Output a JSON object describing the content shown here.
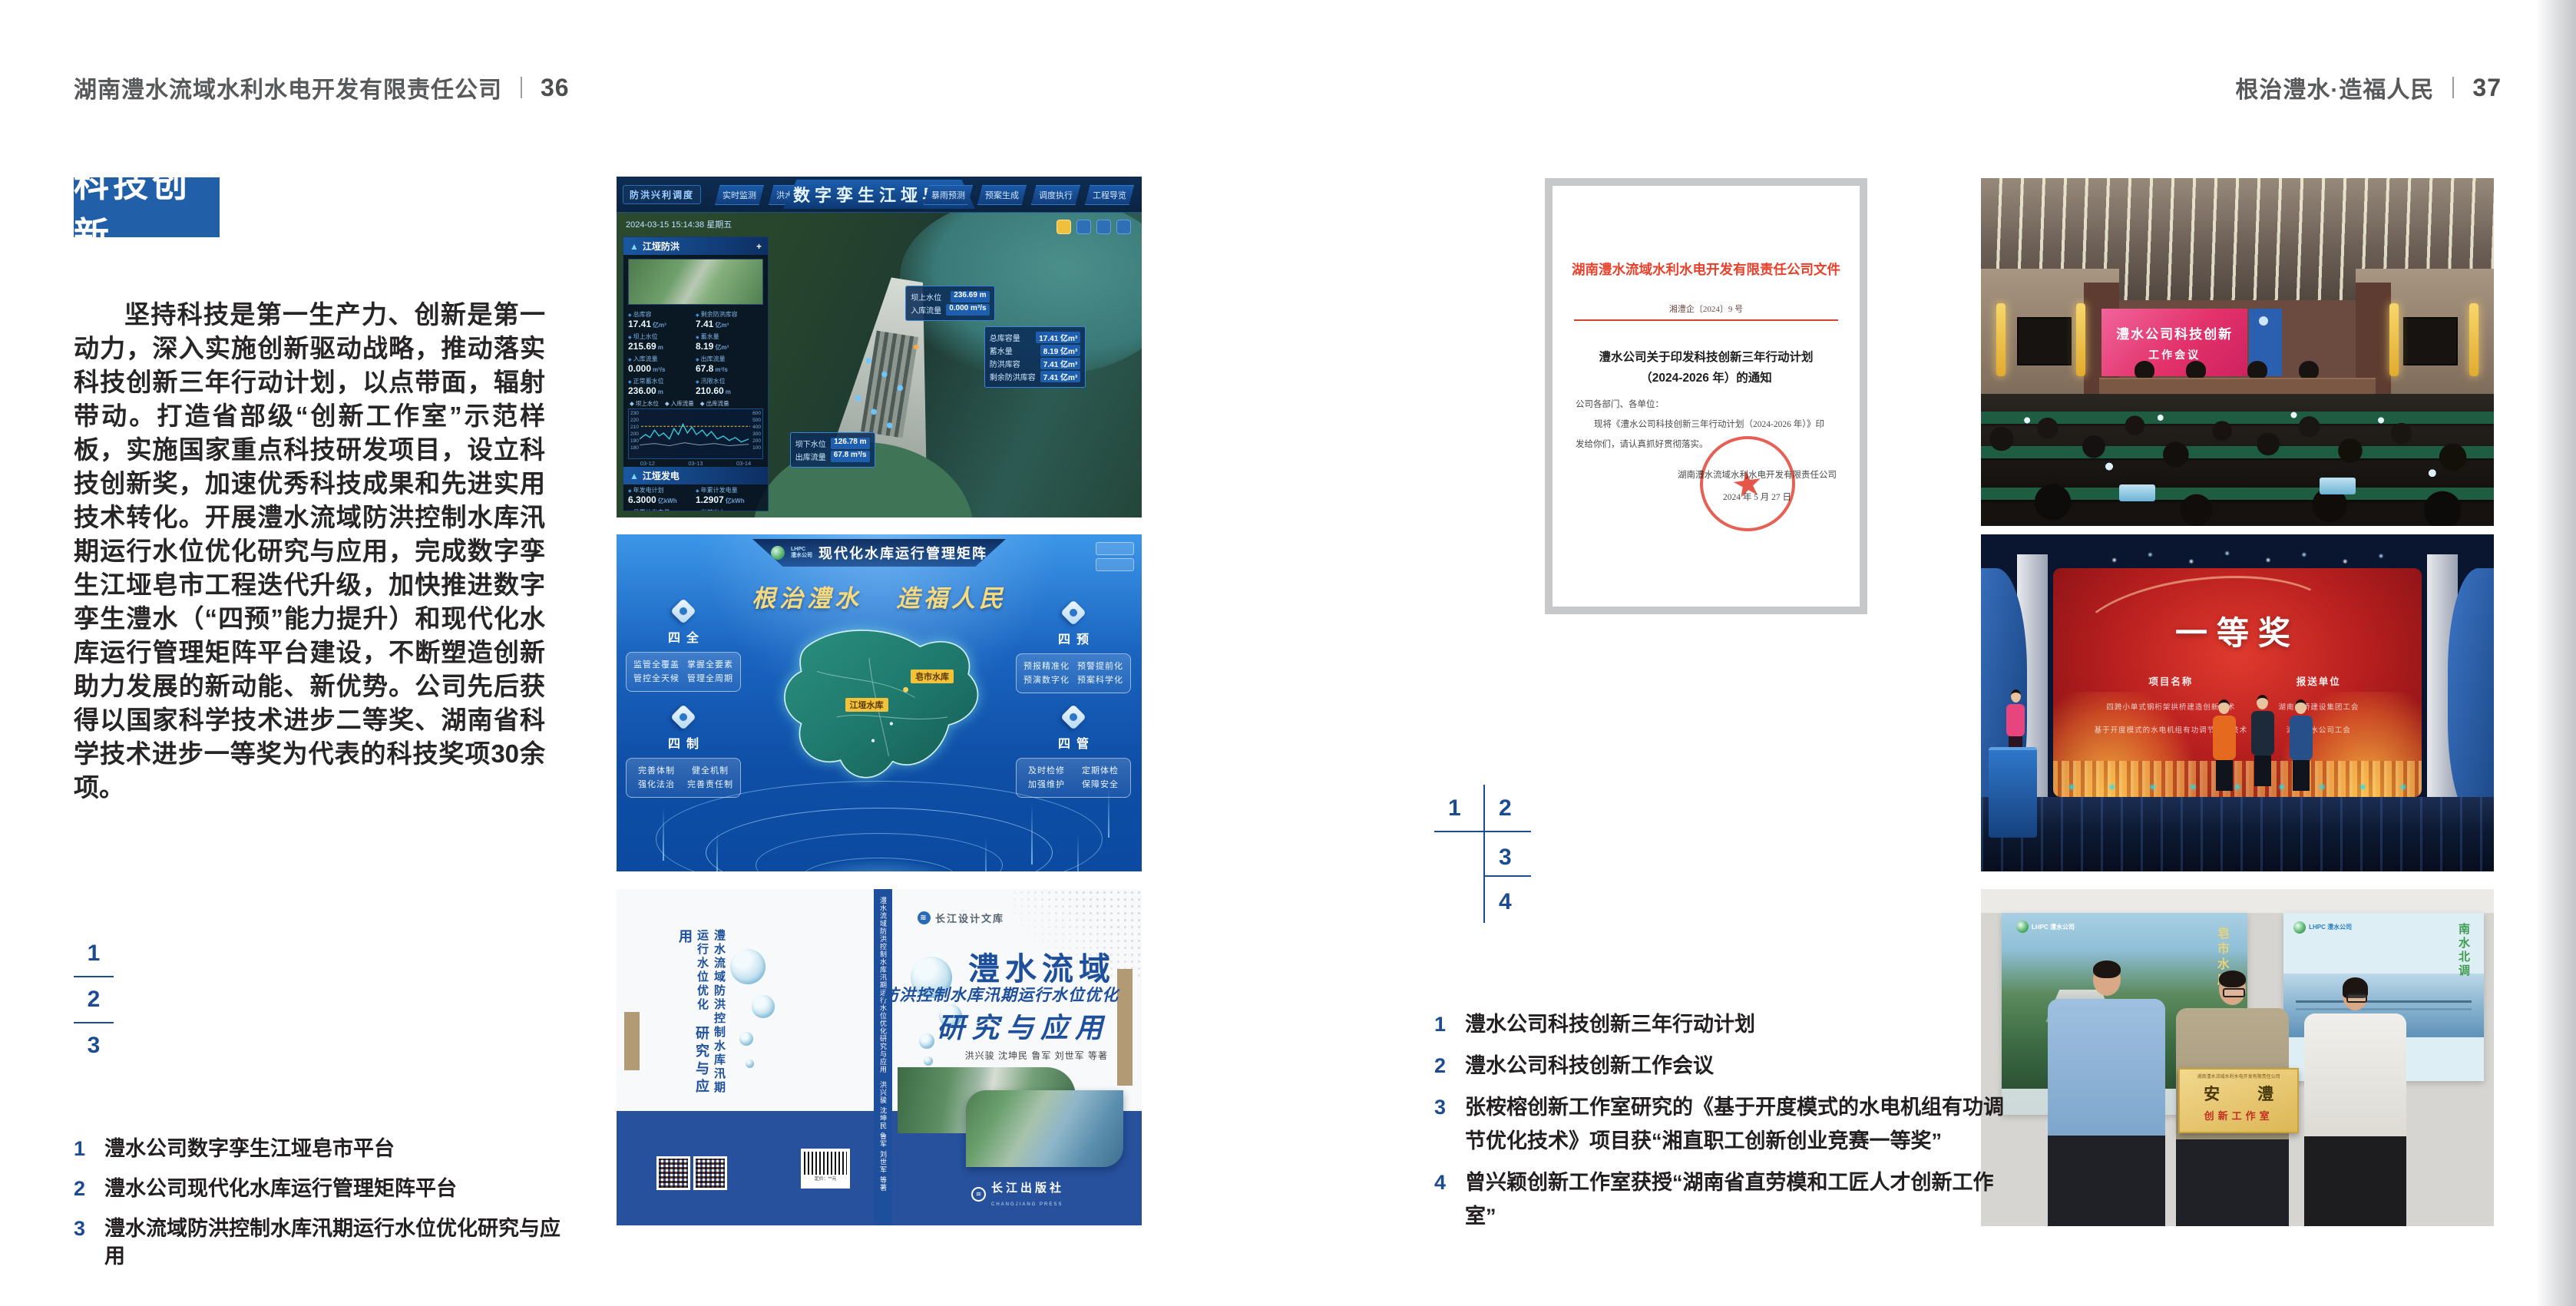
{
  "page_left": {
    "header": {
      "company": "湖南澧水流域水利水电开发有限责任公司",
      "page_no": "36"
    },
    "section_title": "科技创新",
    "body_text": "坚持科技是第一生产力、创新是第一动力，深入实施创新驱动战略，推动落实科技创新三年行动计划，以点带面，辐射带动。打造省部级“创新工作室”示范样板，实施国家重点科技研发项目，设立科技创新奖，加速优秀科技成果和先进实用技术转化。开展澧水流域防洪控制水库汛期运行水位优化研究与应用，完成数字孪生江垭皂市工程迭代升级，加快推进数字孪生澧水（“四预”能力提升）和现代化水库运行管理矩阵平台建设，不断塑造创新助力发展的新动能、新优势。公司先后获得以国家科学技术进步二等奖、湖南省科学技术进步一等奖为代表的科技奖项30余项。",
    "figure_key": [
      "1",
      "2",
      "3"
    ],
    "captions": [
      {
        "no": "1",
        "text": "澧水公司数字孪生江垭皂市平台"
      },
      {
        "no": "2",
        "text": "澧水公司现代化水库运行管理矩阵平台"
      },
      {
        "no": "3",
        "text": "澧水流域防洪控制水库汛期运行水位优化研究与应用"
      }
    ]
  },
  "page_right": {
    "header": {
      "slogan": "根治澧水·造福人民",
      "page_no": "37"
    },
    "figure_key": [
      "1",
      "2",
      "3",
      "4"
    ],
    "captions": [
      {
        "no": "1",
        "text": "澧水公司科技创新三年行动计划"
      },
      {
        "no": "2",
        "text": "澧水公司科技创新工作会议"
      },
      {
        "no": "3",
        "text": "张桉榕创新工作室研究的《基于开度模式的水电机组有功调节优化技术》项目获“湘直职工创新创业竞赛一等奖”"
      },
      {
        "no": "4",
        "text": "曾兴颖创新工作室获授“湖南省直劳模和工匠人才创新工作室”"
      }
    ]
  },
  "dashboard": {
    "corner_tag": "防洪兴利调度",
    "tabs_left": [
      "实时监测",
      "洪水预报",
      "防洪预警"
    ],
    "title": "数字孪生江垭皂市",
    "tabs_right": [
      "暴雨预测",
      "预案生成",
      "调度执行",
      "工程导览"
    ],
    "datetime": "2024-03-15 15:14:38 星期五",
    "panel_flood": {
      "title": "江垭防洪",
      "expand": "+",
      "stats": [
        {
          "label": "总库容",
          "value": "17.41",
          "unit": "亿m³"
        },
        {
          "label": "剩余防洪库容",
          "value": "7.41",
          "unit": "亿m³"
        },
        {
          "label": "坝上水位",
          "value": "215.69",
          "unit": "m"
        },
        {
          "label": "蓄水量",
          "value": "8.19",
          "unit": "亿m³"
        },
        {
          "label": "入库流量",
          "value": "0.000",
          "unit": "m³/s"
        },
        {
          "label": "出库流量",
          "value": "67.8",
          "unit": "m³/s"
        },
        {
          "label": "正常蓄水位",
          "value": "236.00",
          "unit": "m"
        },
        {
          "label": "汛限水位",
          "value": "210.60",
          "unit": "m"
        }
      ]
    },
    "chart": {
      "type": "line",
      "legend": [
        "坝上水位",
        "入库流量",
        "出库流量"
      ],
      "y_left": [
        "230",
        "220",
        "210",
        "200",
        "190",
        "180"
      ],
      "y_right": [
        "600",
        "500",
        "400",
        "300",
        "200",
        "100"
      ],
      "x_labels": [
        "03-12",
        "03-13",
        "03-14"
      ]
    },
    "panel_power": {
      "title": "江垭发电",
      "stats": [
        {
          "label": "年发电计划",
          "value": "6.3000",
          "unit": "亿kWh"
        },
        {
          "label": "年累计发电量",
          "value": "1.2907",
          "unit": "亿kWh"
        },
        {
          "label": "月累计发电量",
          "value": "3359.21",
          "unit": "万kWh"
        },
        {
          "label": "当前出力",
          "value": "0.00",
          "unit": "MW"
        },
        {
          "label": "发电流量",
          "value": "0.00",
          "unit": "m³/s"
        },
        {
          "label": "弃水流量",
          "value": "0.00",
          "unit": "m³/s"
        }
      ],
      "units": [
        "1号机组",
        "2号机组",
        "3号机组"
      ]
    },
    "callout_upstream": [
      {
        "label": "坝上水位",
        "value": "236.69 m"
      },
      {
        "label": "入库流量",
        "value": "0.000 m³/s"
      }
    ],
    "callout_storage": [
      {
        "label": "总库容量",
        "value": "17.41 亿m³"
      },
      {
        "label": "蓄水量",
        "value": "8.19 亿m³"
      },
      {
        "label": "防洪库容",
        "value": "7.41 亿m³"
      },
      {
        "label": "剩余防洪库容",
        "value": "7.41 亿m³"
      }
    ],
    "callout_downstream": [
      {
        "label": "坝下水位",
        "value": "126.78 m"
      },
      {
        "label": "出库流量",
        "value": "67.8 m³/s"
      }
    ]
  },
  "matrix": {
    "brand_line1": "LHPC",
    "brand_line2": "澧水公司",
    "title": "现代化水库运行管理矩阵",
    "slogan_left": "根治澧水",
    "slogan_right": "造福人民",
    "panels": [
      {
        "title": "四全",
        "items": [
          "监管全覆盖",
          "掌握全要素",
          "管控全天候",
          "管理全周期"
        ]
      },
      {
        "title": "四预",
        "items": [
          "预报精准化",
          "预警提前化",
          "预演数字化",
          "预案科学化"
        ]
      },
      {
        "title": "四制",
        "items": [
          "完善体制",
          "健全机制",
          "强化法治",
          "完善责任制"
        ]
      },
      {
        "title": "四管",
        "items": [
          "及时检修",
          "定期体检",
          "加强维护",
          "保障安全"
        ]
      }
    ],
    "map_labels": [
      "皂市水库",
      "江垭水库"
    ]
  },
  "book": {
    "library": "长江设计文库",
    "back_title": "澧水流域防洪控制水库汛期运行水位优化",
    "back_title2": "研究与应用",
    "spine_text": "澧水流域防洪控制水库汛期运行水位优化研究与应用　洪兴骏 沈坤民 鲁军 刘世军 等著",
    "title_main": "澧水流域",
    "title_sub": "防洪控制水库汛期运行水位优化",
    "title_tail": "研究与应用",
    "authors": "洪兴骏 沈坤民 鲁军 刘世军 等著",
    "publisher": "长江出版社",
    "publisher_en": "CHANGJIANG PRESS",
    "barcode_label": "定价：**元"
  },
  "document": {
    "header": "湖南澧水流域水利水电开发有限责任公司文件",
    "doc_no": "湘澧企〔2024〕9 号",
    "title_line1": "澧水公司关于印发科技创新三年行动计划",
    "title_line2": "（2024-2026 年）的通知",
    "salutation": "公司各部门、各单位：",
    "body_line1": "现将《澧水公司科技创新三年行动计划（2024-2026 年）》印",
    "body_line2": "发给你们，请认真抓好贯彻落实。",
    "signer": "湖南澧水流域水利水电开发有限责任公司",
    "sign_date": "2024 年 5 月 27 日"
  },
  "meeting": {
    "screen_line1": "澧水公司科技创新",
    "screen_line2": "工作会议"
  },
  "award": {
    "title": "一等奖",
    "col_project": "项目名称",
    "col_unit": "报送单位",
    "projects": [
      "四跨小单式钢桁架拱桥建造创新技术",
      "基于开度模式的水电机组有功调节优化技术"
    ],
    "units": [
      "湖南路桥建设集团工会",
      "湖南澧水公司工会"
    ]
  },
  "group": {
    "plaque_header": "湖南澧水流域水利水电开发有限责任公司",
    "plaque_main": "安　澧",
    "plaque_sub": "创新工作室",
    "poster_left_brand": "LHPC 澧水公司",
    "poster_left_text": "皂市水库",
    "poster_right_brand": "LHPC 澧水公司",
    "poster_right_text": "南水北调"
  },
  "icons": {
    "expand": "+",
    "diamond": "◆",
    "star": "★",
    "wave": "≋",
    "swirl": "◉"
  },
  "colors": {
    "accent_blue": "#2160a8",
    "key_blue": "#1d4b8f",
    "doc_red": "#e0442e",
    "band_blue": "#27519c"
  }
}
